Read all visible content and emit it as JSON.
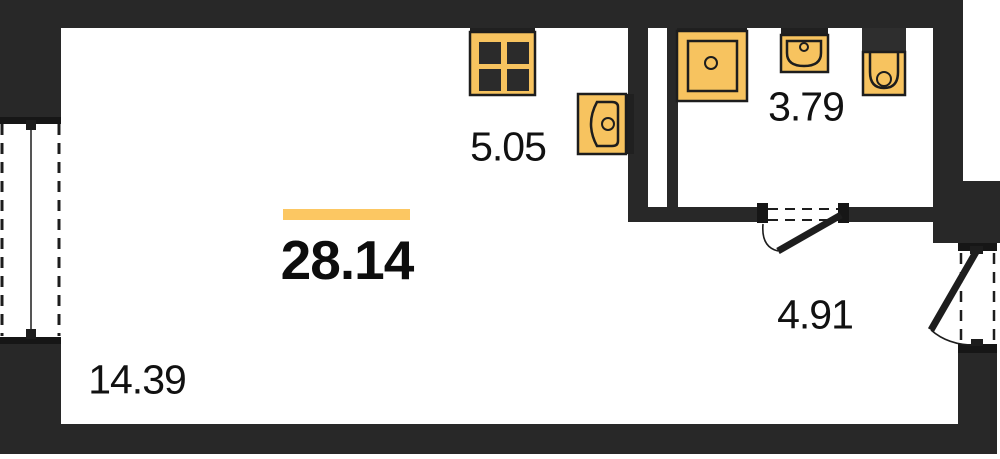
{
  "plan": {
    "total_area_label": "28.14",
    "room_labels": {
      "living": "14.39",
      "kitchen": "5.05",
      "bathroom": "3.79",
      "hallway": "4.91"
    },
    "fixture_icons": [
      "stove-icon",
      "kitchen-sink-icon",
      "shower-tray-icon",
      "washbasin-icon",
      "toilet-icon"
    ],
    "opening_symbols": [
      "left-window",
      "bathroom-door-swing",
      "balcony-door-swing"
    ],
    "colors": {
      "wall": "#282828",
      "sill": "#161616",
      "fixture_fill": "#F7C35F",
      "fixture_outline": "#1d1d1d",
      "highlight_bar": "#FCC762",
      "background": "#FFFFFF",
      "text": "#111111"
    }
  }
}
